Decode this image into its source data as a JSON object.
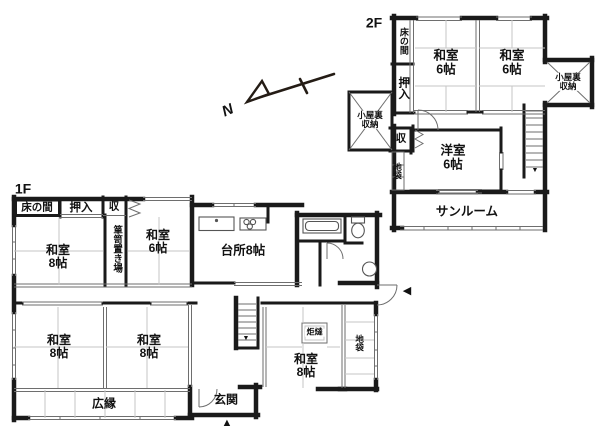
{
  "colors": {
    "wall": "#1a1a1a",
    "thin_line": "#6e6e6e",
    "tatami_line": "#c5c5c5",
    "background": "#ffffff"
  },
  "compass": {
    "label": "N"
  },
  "markers": {
    "stairs_down_2f": "▼",
    "stairs_down_1f": "▼",
    "entrance_main": "▲",
    "entrance_side": "◀"
  },
  "floor2": {
    "label": "2F",
    "rooms": {
      "tokonoma": {
        "label": "床の間"
      },
      "oshiire": {
        "label": "押入"
      },
      "washitsu_a": {
        "name": "和室",
        "size": "6帖"
      },
      "washitsu_b": {
        "name": "和室",
        "size": "6帖"
      },
      "koyaura_storage_left": {
        "line1": "小屋裏",
        "line2": "収納"
      },
      "koyaura_storage_right": {
        "line1": "小屋裏",
        "line2": "収納"
      },
      "closet": {
        "label": "収"
      },
      "jibukuro": {
        "label": "地袋"
      },
      "youshitsu": {
        "name": "洋室",
        "size": "6帖"
      },
      "sunroom": {
        "label": "サンルーム"
      }
    }
  },
  "floor1": {
    "label": "1F",
    "rooms": {
      "tokonoma": {
        "label": "床の間"
      },
      "oshiire": {
        "label": "押入"
      },
      "closet": {
        "label": "収"
      },
      "tansu_okiba": {
        "label": "箪笥置き場"
      },
      "washitsu_6": {
        "name": "和室",
        "size": "6帖"
      },
      "washitsu_8_north": {
        "name": "和室",
        "size": "8帖"
      },
      "kitchen": {
        "label": "台所8帖"
      },
      "washitsu_8_southwest": {
        "name": "和室",
        "size": "8帖"
      },
      "washitsu_8_south": {
        "name": "和室",
        "size": "8帖"
      },
      "washitsu_8_southeast": {
        "name": "和室",
        "size": "8帖"
      },
      "kotatsu": {
        "label": "炬燵"
      },
      "jibukuro": {
        "label": "地袋"
      },
      "hiroen": {
        "label": "広縁"
      },
      "genkan": {
        "label": "玄関"
      }
    }
  }
}
